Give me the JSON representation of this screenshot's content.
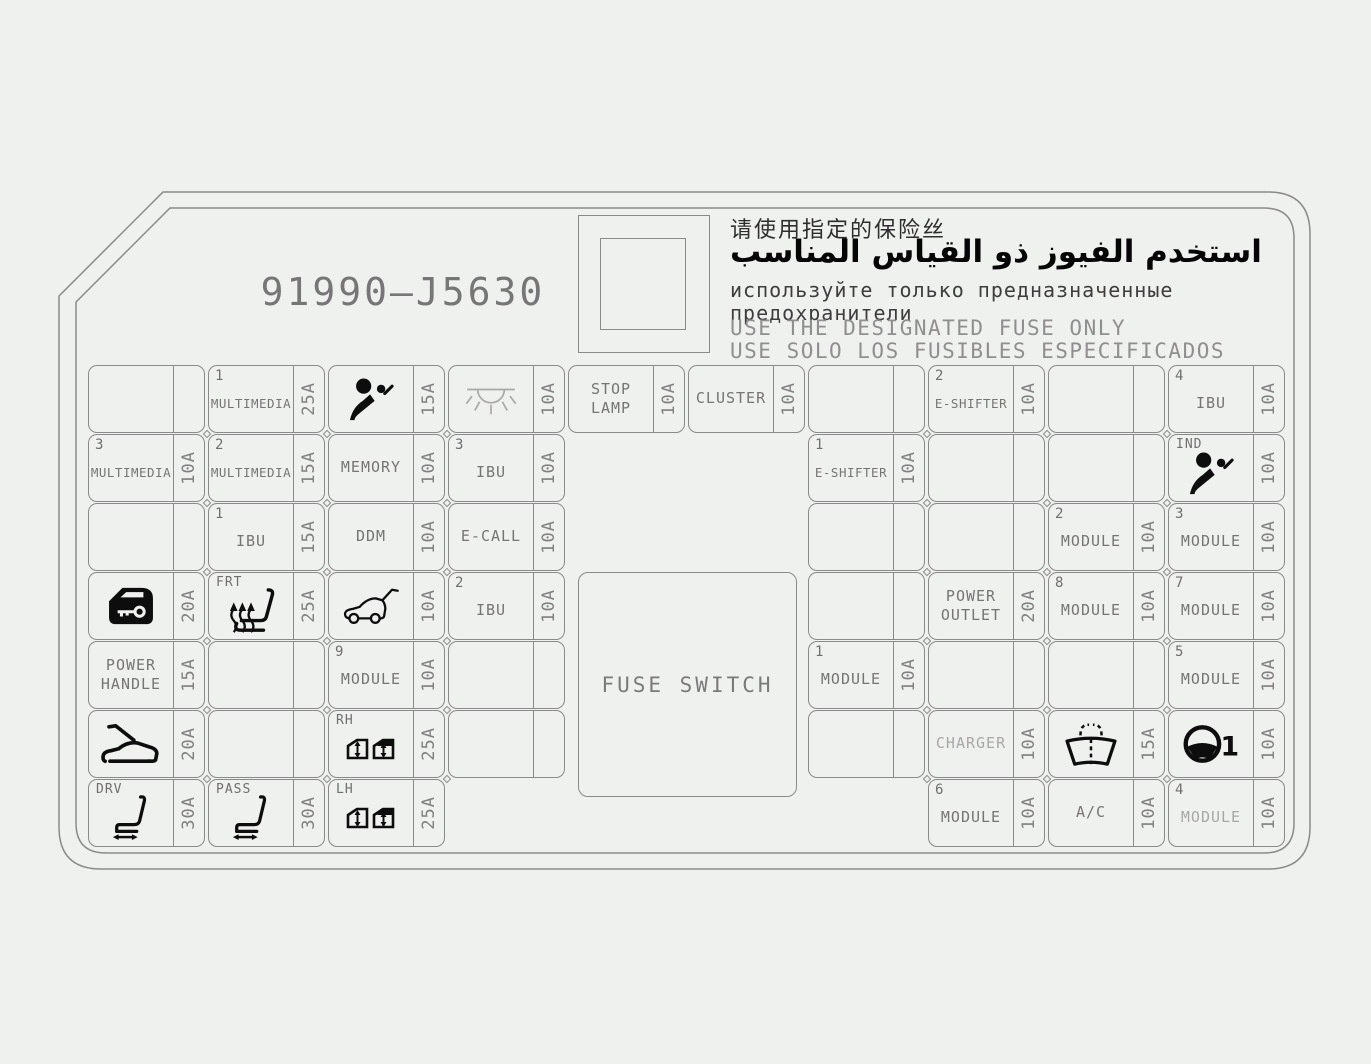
{
  "panel": {
    "part_number": "91990—J5630",
    "fuse_switch_label": "FUSE SWITCH",
    "notices": {
      "zh": "请使用指定的保险丝",
      "ar": "استخدم الفيوز ذو القياس المناسب",
      "ru_1": "используйте только предназначенные",
      "ru_2": "предохранители",
      "en": "USE THE DESIGNATED FUSE ONLY",
      "es": "USE SOLO LOS FUSIBLES ESPECIFICADOS"
    },
    "colors": {
      "background": "#eff1ee",
      "line": "#8a8a8a",
      "text": "#757575",
      "icon": "#0d0d0d",
      "faded_text": "#a8a8a8"
    }
  },
  "fuses": [
    {
      "row": 0,
      "col": 0,
      "amp": ""
    },
    {
      "row": 0,
      "col": 1,
      "num": "1",
      "label": "MULTIMEDIA",
      "amp": "25A"
    },
    {
      "row": 0,
      "col": 2,
      "icon": "airbag",
      "amp": "15A"
    },
    {
      "row": 0,
      "col": 3,
      "icon": "lamp",
      "amp": "10A"
    },
    {
      "row": 0,
      "col": 4,
      "label": "STOP\nLAMP",
      "amp": "10A"
    },
    {
      "row": 0,
      "col": 5,
      "label": "CLUSTER",
      "amp": "10A"
    },
    {
      "row": 0,
      "col": 6,
      "amp": ""
    },
    {
      "row": 0,
      "col": 7,
      "num": "2",
      "label": "E-SHIFTER",
      "amp": "10A"
    },
    {
      "row": 0,
      "col": 8,
      "amp": ""
    },
    {
      "row": 0,
      "col": 9,
      "num": "4",
      "label": "IBU",
      "amp": "10A"
    },
    {
      "row": 1,
      "col": 0,
      "num": "3",
      "label": "MULTIMEDIA",
      "amp": "10A"
    },
    {
      "row": 1,
      "col": 1,
      "num": "2",
      "label": "MULTIMEDIA",
      "amp": "15A"
    },
    {
      "row": 1,
      "col": 2,
      "label": "MEMORY",
      "amp": "10A"
    },
    {
      "row": 1,
      "col": 3,
      "num": "3",
      "label": "IBU",
      "amp": "10A"
    },
    {
      "row": 1,
      "col": 6,
      "num": "1",
      "label": "E-SHIFTER",
      "amp": "10A"
    },
    {
      "row": 1,
      "col": 7,
      "amp": ""
    },
    {
      "row": 1,
      "col": 8,
      "amp": ""
    },
    {
      "row": 1,
      "col": 9,
      "tag": "IND",
      "icon": "airbag",
      "amp": "10A"
    },
    {
      "row": 2,
      "col": 0,
      "amp": ""
    },
    {
      "row": 2,
      "col": 1,
      "num": "1",
      "label": "IBU",
      "amp": "15A"
    },
    {
      "row": 2,
      "col": 2,
      "label": "DDM",
      "amp": "10A"
    },
    {
      "row": 2,
      "col": 3,
      "label": "E-CALL",
      "amp": "10A"
    },
    {
      "row": 2,
      "col": 6,
      "amp": ""
    },
    {
      "row": 2,
      "col": 7,
      "amp": ""
    },
    {
      "row": 2,
      "col": 8,
      "num": "2",
      "label": "MODULE",
      "amp": "10A"
    },
    {
      "row": 2,
      "col": 9,
      "num": "3",
      "label": "MODULE",
      "amp": "10A"
    },
    {
      "row": 3,
      "col": 0,
      "icon": "door-key",
      "amp": "20A"
    },
    {
      "row": 3,
      "col": 1,
      "tag": "FRT",
      "icon": "seat-heater",
      "amp": "25A"
    },
    {
      "row": 3,
      "col": 2,
      "icon": "tailgate",
      "amp": "10A"
    },
    {
      "row": 3,
      "col": 3,
      "num": "2",
      "label": "IBU",
      "amp": "10A"
    },
    {
      "row": 3,
      "col": 6,
      "amp": ""
    },
    {
      "row": 3,
      "col": 7,
      "label": "POWER\nOUTLET",
      "amp": "20A"
    },
    {
      "row": 3,
      "col": 8,
      "num": "8",
      "label": "MODULE",
      "amp": "10A"
    },
    {
      "row": 3,
      "col": 9,
      "num": "7",
      "label": "MODULE",
      "amp": "10A"
    },
    {
      "row": 4,
      "col": 0,
      "label": "POWER\nHANDLE",
      "amp": "15A"
    },
    {
      "row": 4,
      "col": 1,
      "amp": ""
    },
    {
      "row": 4,
      "col": 2,
      "num": "9",
      "label": "MODULE",
      "amp": "10A"
    },
    {
      "row": 4,
      "col": 3,
      "amp": ""
    },
    {
      "row": 4,
      "col": 6,
      "num": "1",
      "label": "MODULE",
      "amp": "10A"
    },
    {
      "row": 4,
      "col": 7,
      "amp": ""
    },
    {
      "row": 4,
      "col": 8,
      "amp": ""
    },
    {
      "row": 4,
      "col": 9,
      "num": "5",
      "label": "MODULE",
      "amp": "10A"
    },
    {
      "row": 5,
      "col": 0,
      "icon": "hood-open",
      "amp": "20A"
    },
    {
      "row": 5,
      "col": 1,
      "amp": ""
    },
    {
      "row": 5,
      "col": 2,
      "tag": "RH",
      "icon": "window-switches",
      "amp": "25A"
    },
    {
      "row": 5,
      "col": 3,
      "amp": ""
    },
    {
      "row": 5,
      "col": 6,
      "amp": ""
    },
    {
      "row": 5,
      "col": 7,
      "label": "CHARGER",
      "amp": "10A",
      "light": true
    },
    {
      "row": 5,
      "col": 8,
      "icon": "wiper",
      "amp": "15A"
    },
    {
      "row": 5,
      "col": 9,
      "icon": "steering-1",
      "amp": "10A"
    },
    {
      "row": 6,
      "col": 0,
      "tag": "DRV",
      "icon": "power-seat",
      "amp": "30A"
    },
    {
      "row": 6,
      "col": 1,
      "tag": "PASS",
      "icon": "power-seat",
      "amp": "30A"
    },
    {
      "row": 6,
      "col": 2,
      "tag": "LH",
      "icon": "window-switches",
      "amp": "25A"
    },
    {
      "row": 6,
      "col": 7,
      "num": "6",
      "label": "MODULE",
      "amp": "10A"
    },
    {
      "row": 6,
      "col": 8,
      "label": "A/C",
      "amp": "10A"
    },
    {
      "row": 6,
      "col": 9,
      "num": "4",
      "label": "MODULE",
      "amp": "10A",
      "light": true
    }
  ]
}
